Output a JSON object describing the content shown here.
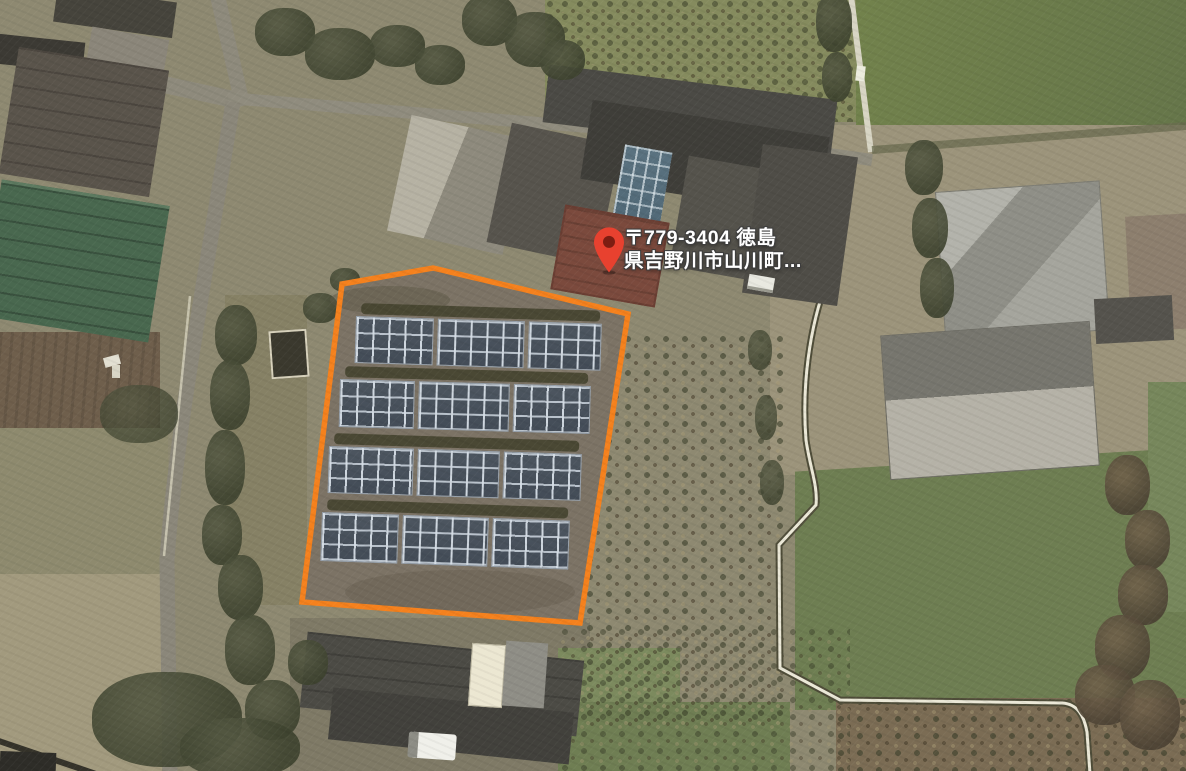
{
  "map": {
    "view_type": "satellite",
    "address_label": {
      "line1": "〒779-3404 徳島",
      "line2": "県吉野川市山川町..."
    },
    "marker": {
      "icon": "map-pin-icon",
      "color": "#e8412f",
      "dot_color": "#7d1d12"
    },
    "site_outline": {
      "color": "#f5811d",
      "shape": "pentagon",
      "solar_array_rows": 4
    }
  }
}
